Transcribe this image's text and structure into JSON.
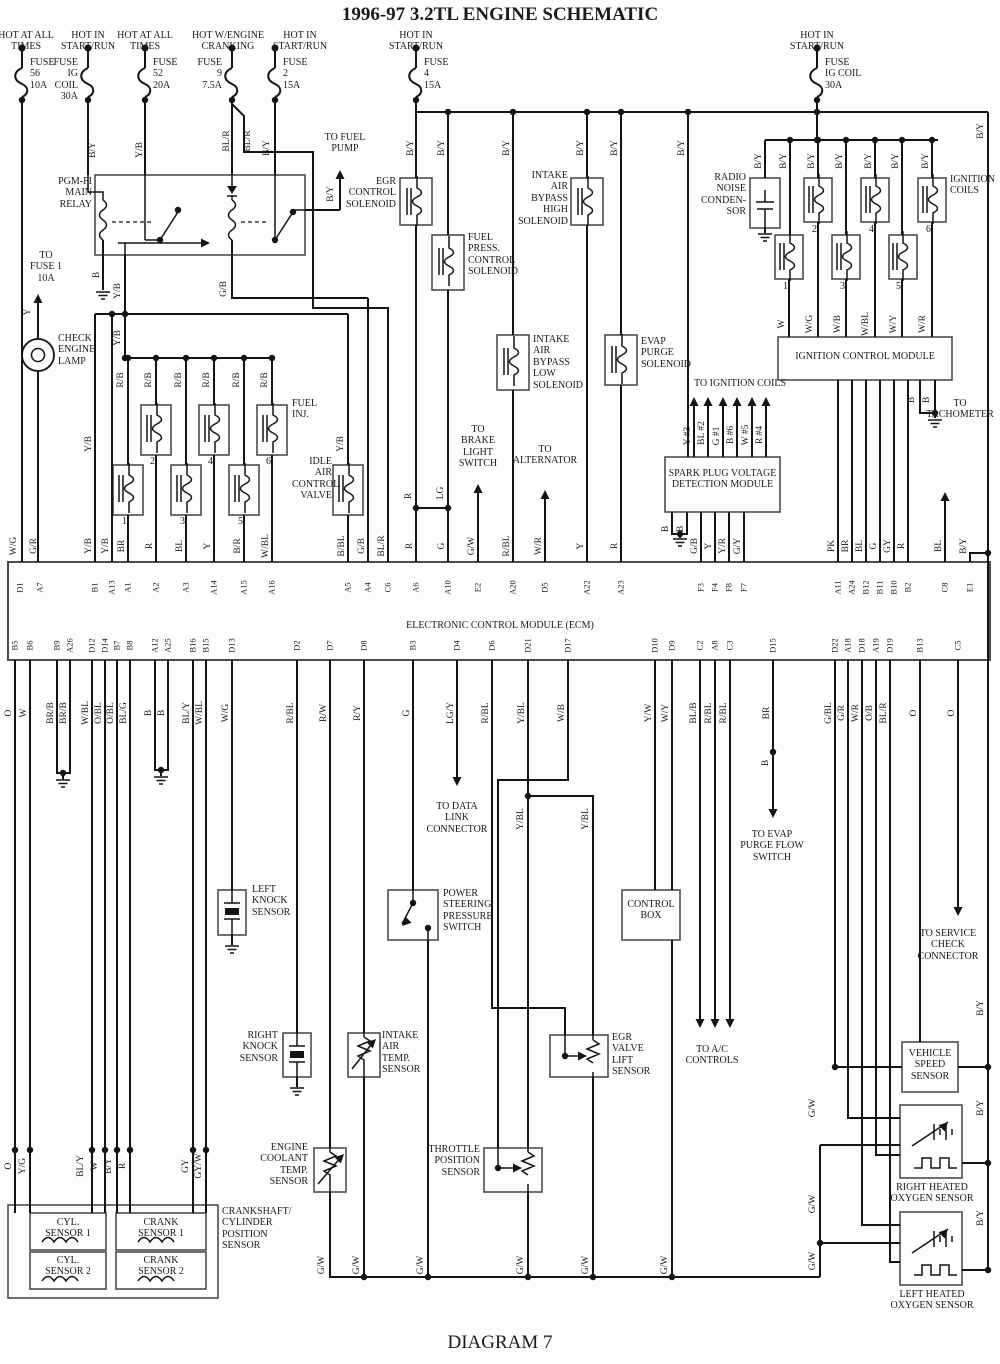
{
  "title": "1996-97 3.2TL ENGINE SCHEMATIC",
  "caption": "DIAGRAM 7",
  "feeds": [
    {
      "x": 22,
      "hx": 26,
      "head": "HOT AT ALL\nTIMES",
      "fuse": "FUSE\n56\n10A",
      "side": "right"
    },
    {
      "x": 88,
      "hx": 88,
      "head": "HOT IN\nSTART/RUN",
      "fuse": "FUSE\nIG\nCOIL\n30A",
      "side": "left"
    },
    {
      "x": 145,
      "hx": 145,
      "head": "HOT AT ALL\nTIMES",
      "fuse": "FUSE\n52\n20A",
      "side": "right"
    },
    {
      "x": 232,
      "hx": 228,
      "head": "HOT W/ENGINE\nCRANKING",
      "fuse": "FUSE\n9\n7.5A",
      "side": "left"
    },
    {
      "x": 275,
      "hx": 300,
      "head": "HOT IN\nSTART/RUN",
      "fuse": "FUSE\n2\n15A",
      "side": "right"
    },
    {
      "x": 416,
      "hx": 416,
      "head": "HOT IN\nSTART/RUN",
      "fuse": "FUSE\n4\n15A",
      "side": "right"
    },
    {
      "x": 817,
      "hx": 817,
      "head": "HOT IN\nSTART/RUN",
      "fuse": "FUSE\nIG COIL\n30A",
      "side": "right"
    }
  ],
  "notes": [
    {
      "name": "pgm-fi-main-relay-label",
      "x": 48,
      "y": 176,
      "w": 44,
      "align": "right",
      "text": "PGM-FI\nMAIN\nRELAY"
    },
    {
      "name": "to-fuse-1-label",
      "x": 26,
      "y": 250,
      "w": 40,
      "align": "center",
      "text": "TO\nFUSE 1\n10A"
    },
    {
      "name": "check-engine-lamp-label",
      "x": 58,
      "y": 333,
      "w": 34,
      "align": "left",
      "text": "CHECK\nENGINE\nLAMP"
    },
    {
      "name": "to-fuel-pump-label",
      "x": 308,
      "y": 132,
      "w": 74,
      "align": "center",
      "text": "TO FUEL\nPUMP"
    },
    {
      "name": "fuel-inj-label",
      "x": 292,
      "y": 398,
      "w": 40,
      "align": "left",
      "text": "FUEL\nINJ."
    },
    {
      "name": "idle-air-control-valve-label",
      "x": 292,
      "y": 456,
      "w": 40,
      "align": "right",
      "text": "IDLE\nAIR\nCONTROL\nVALVE"
    },
    {
      "name": "egr-control-solenoid-label",
      "x": 344,
      "y": 176,
      "w": 52,
      "align": "right",
      "text": "EGR\nCONTROL\nSOLENOID"
    },
    {
      "name": "fuel-press-control-solenoid-label",
      "x": 468,
      "y": 232,
      "w": 42,
      "align": "left",
      "text": "FUEL\nPRESS.\nCONTROL\nSOLENOID"
    },
    {
      "name": "intake-air-bypass-high-solenoid-label",
      "x": 514,
      "y": 170,
      "w": 54,
      "align": "right",
      "text": "INTAKE\nAIR\nBYPASS\nHIGH\nSOLENOID"
    },
    {
      "name": "intake-air-bypass-low-solenoid-label",
      "x": 533,
      "y": 334,
      "w": 44,
      "align": "left",
      "text": "INTAKE\nAIR\nBYPASS\nLOW\nSOLENOID"
    },
    {
      "name": "evap-purge-solenoid-label",
      "x": 641,
      "y": 336,
      "w": 44,
      "align": "left",
      "text": "EVAP\nPURGE\nSOLENOID"
    },
    {
      "name": "radio-noise-condenser-label",
      "x": 694,
      "y": 172,
      "w": 52,
      "align": "right",
      "text": "RADIO\nNOISE\nCONDEN-\nSOR"
    },
    {
      "name": "ignition-coils-label",
      "x": 950,
      "y": 174,
      "w": 50,
      "align": "left",
      "text": "IGNITION\nCOILS"
    },
    {
      "name": "ignition-control-module-label",
      "x": 778,
      "y": 351,
      "w": 174,
      "align": "center",
      "text": "IGNITION CONTROL MODULE"
    },
    {
      "name": "to-ignition-coils-label",
      "x": 680,
      "y": 378,
      "w": 120,
      "align": "center",
      "text": "TO IGNITION COILS"
    },
    {
      "name": "spark-plug-module-label",
      "x": 667,
      "y": 468,
      "w": 111,
      "align": "center",
      "text": "SPARK PLUG VOLTAGE\nDETECTION MODULE"
    },
    {
      "name": "to-brake-light-switch-label",
      "x": 452,
      "y": 424,
      "w": 52,
      "align": "center",
      "text": "TO\nBRAKE\nLIGHT\nSWITCH"
    },
    {
      "name": "to-alternator-label",
      "x": 512,
      "y": 444,
      "w": 66,
      "align": "center",
      "text": "TO\nALTERNATOR"
    },
    {
      "name": "to-tachometer-label",
      "x": 922,
      "y": 398,
      "w": 76,
      "align": "center",
      "text": "TO\nTACHOMETER"
    },
    {
      "name": "ecm-label",
      "x": 300,
      "y": 620,
      "w": 400,
      "align": "center",
      "text": "ELECTRONIC CONTROL MODULE (ECM)"
    },
    {
      "name": "to-data-link-connector-label",
      "x": 424,
      "y": 801,
      "w": 66,
      "align": "center",
      "text": "TO DATA\nLINK\nCONNECTOR"
    },
    {
      "name": "to-evap-purge-flow-switch-label",
      "x": 733,
      "y": 829,
      "w": 78,
      "align": "center",
      "text": "TO EVAP\nPURGE FLOW\nSWITCH"
    },
    {
      "name": "left-knock-sensor-label",
      "x": 252,
      "y": 884,
      "w": 42,
      "align": "left",
      "text": "LEFT\nKNOCK\nSENSOR"
    },
    {
      "name": "right-knock-sensor-label",
      "x": 226,
      "y": 1030,
      "w": 52,
      "align": "right",
      "text": "RIGHT\nKNOCK\nSENSOR"
    },
    {
      "name": "power-steering-pressure-switch-label",
      "x": 443,
      "y": 888,
      "w": 46,
      "align": "left",
      "text": "POWER\nSTEERING\nPRESSURE\nSWITCH"
    },
    {
      "name": "intake-air-temp-sensor-label",
      "x": 382,
      "y": 1030,
      "w": 44,
      "align": "left",
      "text": "INTAKE\nAIR TEMP.\nSENSOR"
    },
    {
      "name": "engine-coolant-temp-sensor-label",
      "x": 248,
      "y": 1142,
      "w": 60,
      "align": "right",
      "text": "ENGINE\nCOOLANT\nTEMP.\nSENSOR"
    },
    {
      "name": "throttle-position-sensor-label",
      "x": 420,
      "y": 1144,
      "w": 60,
      "align": "right",
      "text": "THROTTLE\nPOSITION\nSENSOR"
    },
    {
      "name": "egr-valve-lift-sensor-label",
      "x": 612,
      "y": 1032,
      "w": 52,
      "align": "left",
      "text": "EGR VALVE\nLIFT\nSENSOR"
    },
    {
      "name": "control-box-label",
      "x": 624,
      "y": 899,
      "w": 54,
      "align": "center",
      "text": "CONTROL\nBOX"
    },
    {
      "name": "to-ac-controls-label",
      "x": 678,
      "y": 1044,
      "w": 68,
      "align": "center",
      "text": "TO A/C\nCONTROLS"
    },
    {
      "name": "to-service-check-connector-label",
      "x": 908,
      "y": 928,
      "w": 80,
      "align": "center",
      "text": "TO SERVICE\nCHECK\nCONNECTOR"
    },
    {
      "name": "vehicle-speed-sensor-label",
      "x": 903,
      "y": 1048,
      "w": 54,
      "align": "center",
      "text": "VEHICLE\nSPEED\nSENSOR"
    },
    {
      "name": "right-heated-oxygen-sensor-label",
      "x": 888,
      "y": 1182,
      "w": 88,
      "align": "center",
      "text": "RIGHT HEATED\nOXYGEN SENSOR"
    },
    {
      "name": "left-heated-oxygen-sensor-label",
      "x": 888,
      "y": 1289,
      "w": 88,
      "align": "center",
      "text": "LEFT HEATED\nOXYGEN SENSOR"
    },
    {
      "name": "crankshaft-cylinder-position-sensor-label",
      "x": 222,
      "y": 1206,
      "w": 80,
      "align": "left",
      "text": "CRANKSHAFT/\nCYLINDER\nPOSITION\nSENSOR"
    },
    {
      "name": "cyl-sensor-1-label",
      "x": 30,
      "y": 1217,
      "w": 76,
      "align": "center",
      "text": "CYL.\nSENSOR 1"
    },
    {
      "name": "cyl-sensor-2-label",
      "x": 30,
      "y": 1255,
      "w": 76,
      "align": "center",
      "text": "CYL.\nSENSOR 2"
    },
    {
      "name": "crank-sensor-1-label",
      "x": 116,
      "y": 1217,
      "w": 90,
      "align": "center",
      "text": "CRANK\nSENSOR 1"
    },
    {
      "name": "crank-sensor-2-label",
      "x": 116,
      "y": 1255,
      "w": 90,
      "align": "center",
      "text": "CRANK\nSENSOR 2"
    }
  ],
  "wire_labels": [
    [
      93,
      150,
      "B/Y"
    ],
    [
      140,
      150,
      "Y/B"
    ],
    [
      227,
      141,
      "BL/R"
    ],
    [
      248,
      141,
      "BL/R"
    ],
    [
      267,
      148,
      "B/Y"
    ],
    [
      331,
      194,
      "B/Y"
    ],
    [
      411,
      148,
      "B/Y"
    ],
    [
      442,
      148,
      "B/Y"
    ],
    [
      507,
      148,
      "B/Y"
    ],
    [
      581,
      148,
      "B/Y"
    ],
    [
      615,
      148,
      "B/Y"
    ],
    [
      682,
      148,
      "B/Y"
    ],
    [
      981,
      131,
      "B/Y"
    ],
    [
      759,
      161,
      "B/Y"
    ],
    [
      784,
      161,
      "B/Y"
    ],
    [
      812,
      161,
      "B/Y"
    ],
    [
      840,
      161,
      "B/Y"
    ],
    [
      869,
      161,
      "B/Y"
    ],
    [
      896,
      161,
      "B/Y"
    ],
    [
      926,
      161,
      "B/Y"
    ],
    [
      97,
      275,
      "B"
    ],
    [
      118,
      291,
      "Y/B"
    ],
    [
      224,
      289,
      "G/B"
    ],
    [
      118,
      338,
      "Y/B"
    ],
    [
      28,
      312,
      "Y"
    ],
    [
      89,
      444,
      "Y/B"
    ],
    [
      341,
      444,
      "Y/B"
    ],
    [
      121,
      380,
      "R/B"
    ],
    [
      149,
      380,
      "R/B"
    ],
    [
      179,
      380,
      "R/B"
    ],
    [
      207,
      380,
      "R/B"
    ],
    [
      237,
      380,
      "R/B"
    ],
    [
      265,
      380,
      "R/B"
    ],
    [
      409,
      496,
      "R"
    ],
    [
      441,
      493,
      "LG"
    ],
    [
      782,
      324,
      "W"
    ],
    [
      810,
      324,
      "W/G"
    ],
    [
      838,
      324,
      "W/B"
    ],
    [
      866,
      324,
      "W/BL"
    ],
    [
      894,
      324,
      "W/Y"
    ],
    [
      923,
      324,
      "W/R"
    ],
    [
      688,
      436,
      "Y #3"
    ],
    [
      702,
      433,
      "BL #2"
    ],
    [
      717,
      436,
      "G #1"
    ],
    [
      731,
      435,
      "B #6"
    ],
    [
      746,
      435,
      "W #5"
    ],
    [
      760,
      435,
      "R #4"
    ],
    [
      666,
      529,
      "B"
    ],
    [
      681,
      529,
      "B"
    ],
    [
      912,
      400,
      "B"
    ],
    [
      927,
      400,
      "B"
    ],
    [
      14,
      546,
      "W/G"
    ],
    [
      34,
      546,
      "G/R"
    ],
    [
      89,
      546,
      "Y/B"
    ],
    [
      106,
      546,
      "Y/B"
    ],
    [
      122,
      546,
      "BR"
    ],
    [
      150,
      546,
      "R"
    ],
    [
      180,
      546,
      "BL"
    ],
    [
      208,
      546,
      "Y"
    ],
    [
      238,
      546,
      "B/R"
    ],
    [
      266,
      546,
      "W/BL"
    ],
    [
      342,
      546,
      "B/BL"
    ],
    [
      362,
      546,
      "G/B"
    ],
    [
      382,
      546,
      "BL/R"
    ],
    [
      410,
      546,
      "R"
    ],
    [
      442,
      546,
      "G"
    ],
    [
      472,
      546,
      "G/W"
    ],
    [
      507,
      546,
      "R/BL"
    ],
    [
      539,
      546,
      "W/R"
    ],
    [
      581,
      546,
      "Y"
    ],
    [
      615,
      546,
      "R"
    ],
    [
      695,
      546,
      "G/B"
    ],
    [
      709,
      546,
      "Y"
    ],
    [
      723,
      546,
      "Y/R"
    ],
    [
      738,
      546,
      "G/Y"
    ],
    [
      832,
      546,
      "PK"
    ],
    [
      846,
      546,
      "BR"
    ],
    [
      860,
      546,
      "BL"
    ],
    [
      874,
      546,
      "G"
    ],
    [
      888,
      546,
      "GY"
    ],
    [
      902,
      546,
      "R"
    ],
    [
      939,
      546,
      "BL"
    ],
    [
      964,
      546,
      "B/Y"
    ],
    [
      9,
      713,
      "O"
    ],
    [
      24,
      713,
      "W"
    ],
    [
      51,
      713,
      "BR/B"
    ],
    [
      64,
      713,
      "BR/B"
    ],
    [
      86,
      713,
      "W/BL"
    ],
    [
      99,
      713,
      "O/BL"
    ],
    [
      111,
      713,
      "O/BL"
    ],
    [
      124,
      713,
      "BL/G"
    ],
    [
      149,
      713,
      "B"
    ],
    [
      162,
      713,
      "B"
    ],
    [
      187,
      713,
      "BL/Y"
    ],
    [
      200,
      713,
      "W/BL"
    ],
    [
      226,
      713,
      "W/G"
    ],
    [
      291,
      713,
      "R/BL"
    ],
    [
      324,
      713,
      "R/W"
    ],
    [
      358,
      713,
      "R/Y"
    ],
    [
      407,
      713,
      "G"
    ],
    [
      451,
      713,
      "LG/Y"
    ],
    [
      486,
      713,
      "R/BL"
    ],
    [
      522,
      713,
      "Y/BL"
    ],
    [
      562,
      713,
      "W/B"
    ],
    [
      649,
      713,
      "Y/W"
    ],
    [
      666,
      713,
      "W/Y"
    ],
    [
      694,
      713,
      "BL/B"
    ],
    [
      709,
      713,
      "R/BL"
    ],
    [
      724,
      713,
      "R/BL"
    ],
    [
      767,
      713,
      "BR"
    ],
    [
      829,
      713,
      "G/BL"
    ],
    [
      842,
      713,
      "G/R"
    ],
    [
      856,
      713,
      "W/R"
    ],
    [
      870,
      713,
      "O/B"
    ],
    [
      884,
      713,
      "BL/R"
    ],
    [
      914,
      713,
      "O"
    ],
    [
      952,
      713,
      "O"
    ],
    [
      521,
      819,
      "Y/BL"
    ],
    [
      586,
      819,
      "Y/BL"
    ],
    [
      766,
      763,
      "B"
    ],
    [
      813,
      1108,
      "G/W"
    ],
    [
      813,
      1204,
      "G/W"
    ],
    [
      813,
      1261,
      "G/W"
    ],
    [
      981,
      1008,
      "B/Y"
    ],
    [
      981,
      1108,
      "B/Y"
    ],
    [
      981,
      1218,
      "B/Y"
    ],
    [
      322,
      1265,
      "G/W"
    ],
    [
      357,
      1265,
      "G/W"
    ],
    [
      421,
      1265,
      "G/W"
    ],
    [
      521,
      1265,
      "G/W"
    ],
    [
      586,
      1265,
      "G/W"
    ],
    [
      665,
      1265,
      "G/W"
    ],
    [
      9,
      1166,
      "O"
    ],
    [
      23,
      1166,
      "Y/G"
    ],
    [
      81,
      1166,
      "BL/Y"
    ],
    [
      95,
      1166,
      "W"
    ],
    [
      109,
      1166,
      "B/Y"
    ],
    [
      123,
      1166,
      "R"
    ],
    [
      186,
      1166,
      "GY"
    ],
    [
      199,
      1166,
      "GY/W"
    ]
  ],
  "pins_top": {
    "y": 588,
    "items": [
      [
        20,
        "D1"
      ],
      [
        40,
        "A7"
      ],
      [
        95,
        "B1"
      ],
      [
        112,
        "A13"
      ],
      [
        128,
        "A1"
      ],
      [
        156,
        "A2"
      ],
      [
        186,
        "A3"
      ],
      [
        214,
        "A14"
      ],
      [
        244,
        "A15"
      ],
      [
        272,
        "A16"
      ],
      [
        348,
        "A5"
      ],
      [
        368,
        "A4"
      ],
      [
        388,
        "C6"
      ],
      [
        416,
        "A6"
      ],
      [
        448,
        "A10"
      ],
      [
        478,
        "E2"
      ],
      [
        513,
        "A20"
      ],
      [
        545,
        "D5"
      ],
      [
        587,
        "A22"
      ],
      [
        621,
        "A23"
      ],
      [
        701,
        "F3"
      ],
      [
        715,
        "F4"
      ],
      [
        729,
        "F8"
      ],
      [
        744,
        "F7"
      ],
      [
        838,
        "A11"
      ],
      [
        852,
        "A24"
      ],
      [
        866,
        "B12"
      ],
      [
        880,
        "B11"
      ],
      [
        894,
        "B10"
      ],
      [
        908,
        "B2"
      ],
      [
        945,
        "C8"
      ],
      [
        970,
        "E1"
      ]
    ]
  },
  "pins_bottom": {
    "y": 646,
    "items": [
      [
        15,
        "B5"
      ],
      [
        30,
        "B6"
      ],
      [
        57,
        "B9"
      ],
      [
        70,
        "A26"
      ],
      [
        92,
        "D12"
      ],
      [
        105,
        "D14"
      ],
      [
        117,
        "B7"
      ],
      [
        130,
        "B8"
      ],
      [
        155,
        "A12"
      ],
      [
        168,
        "A25"
      ],
      [
        193,
        "B16"
      ],
      [
        206,
        "B15"
      ],
      [
        232,
        "D13"
      ],
      [
        297,
        "D2"
      ],
      [
        330,
        "D7"
      ],
      [
        364,
        "D8"
      ],
      [
        413,
        "B3"
      ],
      [
        457,
        "D4"
      ],
      [
        492,
        "D6"
      ],
      [
        528,
        "D21"
      ],
      [
        568,
        "D17"
      ],
      [
        655,
        "D10"
      ],
      [
        672,
        "D9"
      ],
      [
        700,
        "C2"
      ],
      [
        715,
        "A8"
      ],
      [
        730,
        "C3"
      ],
      [
        773,
        "D15"
      ],
      [
        835,
        "D22"
      ],
      [
        848,
        "A18"
      ],
      [
        862,
        "D18"
      ],
      [
        876,
        "A19"
      ],
      [
        890,
        "D19"
      ],
      [
        920,
        "B13"
      ],
      [
        958,
        "C5"
      ]
    ]
  },
  "numbers": [
    [
      122,
      516,
      "1"
    ],
    [
      150,
      456,
      "2"
    ],
    [
      180,
      516,
      "3"
    ],
    [
      208,
      456,
      "4"
    ],
    [
      238,
      516,
      "5"
    ],
    [
      266,
      456,
      "6"
    ],
    [
      783,
      281,
      "1"
    ],
    [
      812,
      224,
      "2"
    ],
    [
      840,
      281,
      "3"
    ],
    [
      869,
      224,
      "4"
    ],
    [
      896,
      281,
      "5"
    ],
    [
      926,
      224,
      "6"
    ]
  ]
}
